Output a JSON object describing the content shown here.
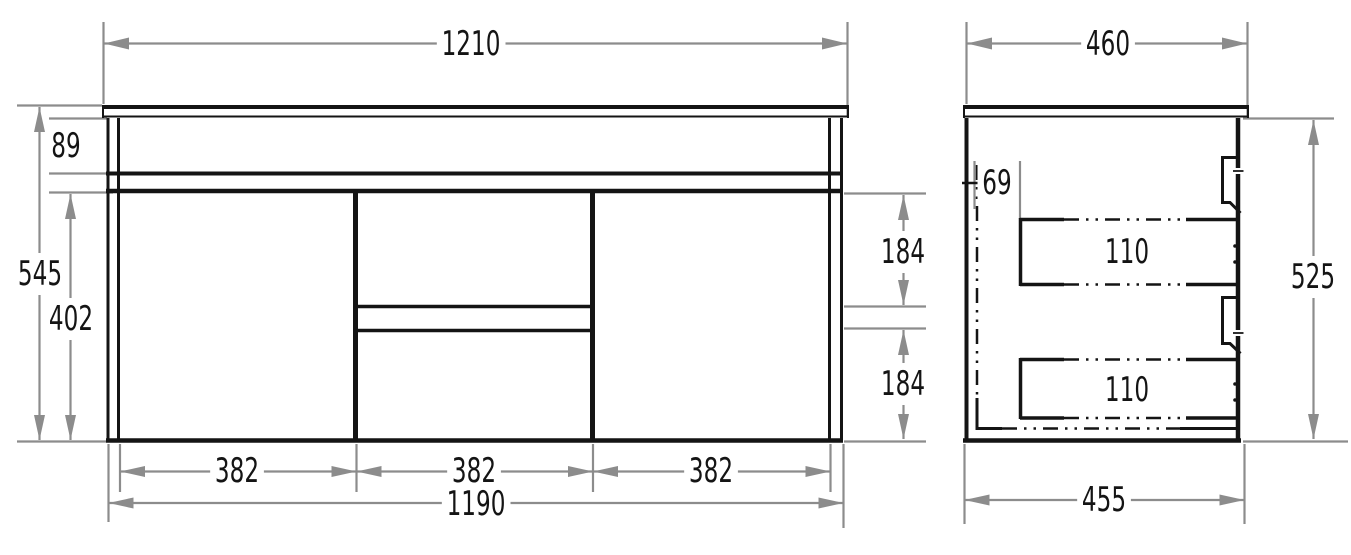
{
  "drawing": {
    "type": "vanity-cabinet-technical-drawing",
    "views": {
      "front": {
        "dims": {
          "overall_width": "1210",
          "counter_rail_height": "89",
          "overall_height": "545",
          "front_panel_height": "402",
          "upper_drawer_height": "184",
          "lower_drawer_height": "184",
          "section_width_left": "382",
          "section_width_middle": "382",
          "section_width_right": "382",
          "body_width": "1190"
        }
      },
      "side": {
        "dims": {
          "counter_depth": "460",
          "back_clearance": "69",
          "upper_runner_height": "110",
          "lower_runner_height": "110",
          "body_height": "525",
          "body_depth": "455"
        }
      }
    },
    "colors": {
      "drawing_line": "#141414",
      "dimension_line": "#8c8c8c",
      "text": "#141414",
      "background": "#ffffff"
    }
  }
}
